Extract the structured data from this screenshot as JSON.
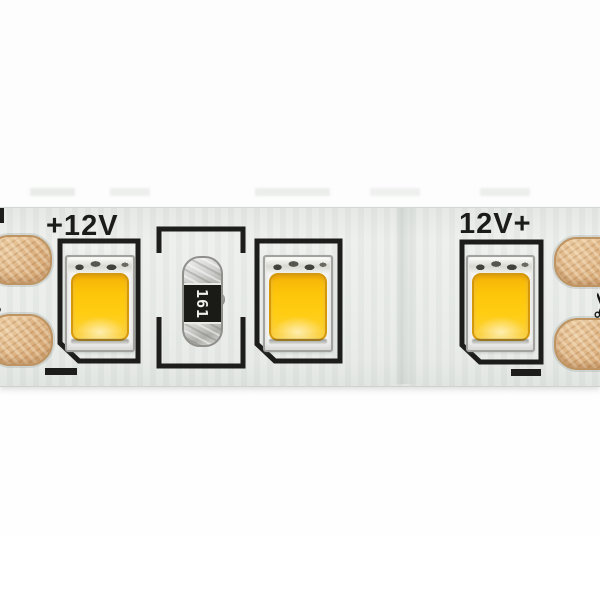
{
  "meta": {
    "type": "product-photo",
    "subject": "Close-up of a 12V LED strip segment with 3 SMD LEDs, a 161 resistor and copper cut pads"
  },
  "canvas": {
    "background_color": "#ffffff"
  },
  "strip": {
    "pcb_color": "#eaedea",
    "silkscreen_color": "#1d1d1b",
    "copper_color": "#d9ab79",
    "voltage_label_left": "+12V",
    "voltage_label_right": "12V+",
    "minus_mark": "−",
    "scissors_icon": "✂",
    "resistor": {
      "marking": "161",
      "body_color": "#c9c9c7",
      "band_color": "#1a1a17",
      "marking_color": "#efefec"
    },
    "leds": [
      {
        "id": "led-1",
        "phosphor_color": "#fdc60a",
        "polarity": "minus bar bottom-left, chamfered outline corner"
      },
      {
        "id": "led-2",
        "phosphor_color": "#fdc60a",
        "polarity": "chamfered outline corner bottom-left"
      },
      {
        "id": "led-3",
        "phosphor_color": "#fdc60a",
        "polarity": "minus bar bottom-right, chamfered outline corner"
      }
    ],
    "cut_pads": {
      "left_count": 2,
      "right_count": 2
    }
  }
}
